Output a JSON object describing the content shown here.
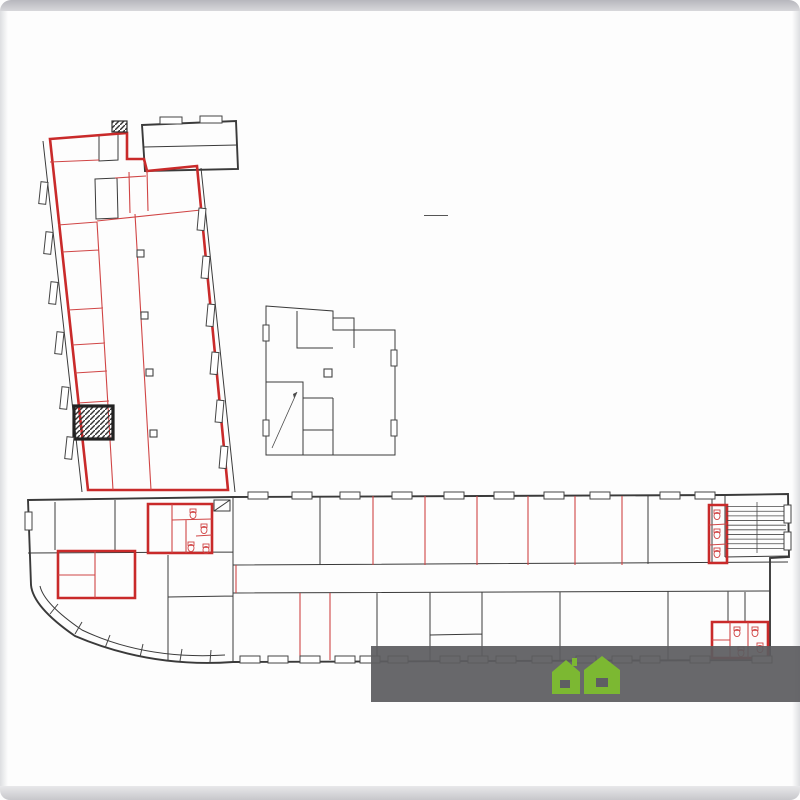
{
  "title": {
    "floor_number": "2",
    "floor_word": "ЭТАЖ"
  },
  "watermark": {
    "text_left": "Квартиры-до",
    "text_right": "ики.рф",
    "house_color": "#7cb832"
  },
  "plan": {
    "accent_red": "#c92a2a",
    "stair_letters": [
      "А",
      "Б",
      "В",
      "Г"
    ],
    "stair_numerals": [
      "I",
      "II",
      "III"
    ],
    "labels": [
      {
        "t": "11а",
        "a": "12.4",
        "x": 73,
        "y": 149,
        "c": "r"
      },
      {
        "t": "12",
        "x": 108,
        "y": 148,
        "c": "k"
      },
      {
        "t": "10",
        "a": "12.6",
        "x": 122,
        "y": 164,
        "c": "r"
      },
      {
        "t": "9",
        "x": 106,
        "y": 199,
        "c": "k"
      },
      {
        "t": "11",
        "a": "11.2",
        "x": 72,
        "y": 191,
        "c": "r"
      },
      {
        "t": "13",
        "a": "5.8",
        "x": 137,
        "y": 184,
        "c": "r"
      },
      {
        "t": "14",
        "a": "10.7",
        "x": 170,
        "y": 180,
        "c": "r"
      },
      {
        "t": "7",
        "a": "11.5",
        "x": 75,
        "y": 232,
        "c": "r"
      },
      {
        "t": "6",
        "a": "15.4",
        "x": 81,
        "y": 280,
        "c": "r"
      },
      {
        "t": "5",
        "a": "9.0",
        "x": 86,
        "y": 325,
        "c": "r"
      },
      {
        "t": "4",
        "a": "8.1",
        "x": 89,
        "y": 355,
        "c": "r"
      },
      {
        "t": "3",
        "a": "8.0",
        "x": 88,
        "y": 387,
        "c": "r"
      },
      {
        "t": "2",
        "a": "6.1",
        "x": 93,
        "y": 419,
        "c": "r"
      },
      {
        "t": "1",
        "a": "16.1",
        "x": 96,
        "y": 459,
        "c": "r"
      },
      {
        "t": "8",
        "a": "34.7",
        "x": 116,
        "y": 334,
        "c": "r"
      },
      {
        "t": "15",
        "a": "177.2",
        "x": 168,
        "y": 345,
        "c": "r"
      },
      {
        "t": "3.20",
        "x": 50,
        "y": 153,
        "c": "dr",
        "v": 1
      },
      {
        "t": "4.59",
        "x": 77,
        "y": 169,
        "c": "dk"
      },
      {
        "t": "1.92",
        "x": 116,
        "y": 137,
        "c": "dk"
      },
      {
        "t": "3.40",
        "x": 80,
        "y": 208,
        "c": "dk"
      },
      {
        "t": "3.40",
        "x": 167,
        "y": 200,
        "c": "dk"
      },
      {
        "t": "3.13",
        "x": 196,
        "y": 186,
        "c": "dk",
        "v": 1
      },
      {
        "t": "7.25",
        "x": 170,
        "y": 219,
        "c": "dr"
      },
      {
        "t": "3.22",
        "x": 77,
        "y": 251,
        "c": "dr"
      },
      {
        "t": "3.58",
        "x": 56,
        "y": 236,
        "c": "dr",
        "v": 1
      },
      {
        "t": "3.30",
        "x": 80,
        "y": 303,
        "c": "dr"
      },
      {
        "t": "4.68",
        "x": 60,
        "y": 283,
        "c": "dr",
        "v": 1
      },
      {
        "t": "3.30",
        "x": 82,
        "y": 342,
        "c": "dr"
      },
      {
        "t": "2.75",
        "x": 63,
        "y": 330,
        "c": "dr",
        "v": 1
      },
      {
        "t": "3.30",
        "x": 77,
        "y": 371,
        "c": "dr"
      },
      {
        "t": "2.46",
        "x": 66,
        "y": 357,
        "c": "dr",
        "v": 1
      },
      {
        "t": "3.25",
        "x": 88,
        "y": 380,
        "c": "dr"
      },
      {
        "t": "2.48",
        "x": 68,
        "y": 389,
        "c": "dr",
        "v": 1
      },
      {
        "t": "3.22",
        "x": 86,
        "y": 445,
        "c": "dr"
      },
      {
        "t": "4.92",
        "x": 67,
        "y": 464,
        "c": "dr",
        "v": 1
      },
      {
        "t": "5.10",
        "x": 113,
        "y": 465,
        "c": "dr",
        "v": 1
      },
      {
        "t": "8.42",
        "x": 117,
        "y": 293,
        "c": "dr",
        "v": 1
      },
      {
        "t": "24.45",
        "x": 132,
        "y": 382,
        "c": "dr",
        "v": 1
      },
      {
        "t": "15.85",
        "x": 126,
        "y": 427,
        "c": "dr",
        "v": 1
      },
      {
        "t": "А",
        "x": 136,
        "y": 141,
        "c": "k",
        "fs": 10
      },
      {
        "t": "3",
        "a": "8.3",
        "x": 315,
        "y": 326,
        "c": "k"
      },
      {
        "t": "2",
        "a": "82.7",
        "x": 366,
        "y": 404,
        "c": "k"
      },
      {
        "t": "1",
        "a": "7.8",
        "x": 318,
        "y": 444,
        "c": "k"
      },
      {
        "t": "Г",
        "x": 292,
        "y": 394,
        "c": "k",
        "fs": 10
      },
      {
        "t": "III",
        "x": 278,
        "y": 393,
        "c": "r",
        "fs": 8,
        "box": 1
      },
      {
        "t": "2.28",
        "x": 284,
        "y": 317,
        "c": "dk"
      },
      {
        "t": "2.82",
        "x": 314,
        "y": 315,
        "c": "dk"
      },
      {
        "t": "2.95",
        "x": 301,
        "y": 331,
        "c": "dk",
        "v": 1
      },
      {
        "t": "2.97",
        "x": 313,
        "y": 353,
        "c": "dk"
      },
      {
        "t": "5.72",
        "x": 272,
        "y": 349,
        "c": "dk",
        "v": 1
      },
      {
        "t": "5.08",
        "x": 310,
        "y": 366,
        "c": "dk"
      },
      {
        "t": "6.05",
        "x": 271,
        "y": 412,
        "c": "dk",
        "v": 1
      },
      {
        "t": "2.52",
        "x": 289,
        "y": 452,
        "c": "dk"
      },
      {
        "t": "2.23",
        "x": 320,
        "y": 397,
        "c": "dk"
      },
      {
        "t": "2.12",
        "x": 309,
        "y": 428,
        "c": "dk",
        "v": 1
      },
      {
        "t": "4.07",
        "x": 302,
        "y": 416,
        "c": "dk",
        "v": 1
      },
      {
        "t": "7.35",
        "x": 338,
        "y": 414,
        "c": "dk",
        "v": 1
      },
      {
        "t": "Б",
        "x": 47,
        "y": 523,
        "c": "k",
        "fs": 10
      },
      {
        "t": "I",
        "x": 133,
        "y": 514,
        "c": "r",
        "fs": 8,
        "box": 1
      },
      {
        "t": "В",
        "x": 753,
        "y": 508,
        "c": "k",
        "fs": 10
      },
      {
        "t": "II",
        "x": 744,
        "y": 554,
        "c": "r",
        "fs": 8,
        "box": 1
      },
      {
        "t": "3.75",
        "x": 36,
        "y": 525,
        "c": "dk",
        "v": 1
      },
      {
        "t": "10.34",
        "x": 131,
        "y": 545,
        "c": "dk"
      },
      {
        "t": "5.67",
        "x": 200,
        "y": 561,
        "c": "dk"
      },
      {
        "t": "5",
        "a": "7.4",
        "x": 159,
        "y": 522,
        "c": "r"
      },
      {
        "t": "8",
        "x": 187,
        "y": 514,
        "c": "r",
        "fs": 6
      },
      {
        "t": "6",
        "x": 186,
        "y": 528,
        "c": "r",
        "fs": 6
      },
      {
        "t": "7",
        "x": 201,
        "y": 547,
        "c": "r",
        "fs": 6
      },
      {
        "t": "9",
        "x": 221,
        "y": 530,
        "c": "k"
      },
      {
        "t": "10",
        "a": "45.9",
        "x": 277,
        "y": 530,
        "c": "k"
      },
      {
        "t": "11",
        "a": "23.2",
        "x": 351,
        "y": 530,
        "c": "r"
      },
      {
        "t": "12",
        "a": "23.1",
        "x": 401,
        "y": 530,
        "c": "r"
      },
      {
        "t": "13",
        "a": "23.0",
        "x": 451,
        "y": 530,
        "c": "r"
      },
      {
        "t": "14",
        "a": "23.0",
        "x": 502,
        "y": 530,
        "c": "r"
      },
      {
        "t": "15",
        "a": "23.0",
        "x": 551,
        "y": 530,
        "c": "r"
      },
      {
        "t": "16",
        "a": "23.1",
        "x": 598,
        "y": 530,
        "c": "r"
      },
      {
        "t": "17",
        "a": "10.7",
        "x": 636,
        "y": 530,
        "c": "r"
      },
      {
        "t": "18",
        "a": "24.3",
        "x": 679,
        "y": 527,
        "c": "k"
      },
      {
        "t": "19",
        "x": 718,
        "y": 517,
        "c": "r",
        "fs": 6
      },
      {
        "t": "37",
        "a": "108.5",
        "x": 497,
        "y": 577,
        "c": "r"
      },
      {
        "t": "8.27",
        "x": 280,
        "y": 506,
        "c": "dk"
      },
      {
        "t": "4.18",
        "x": 352,
        "y": 504,
        "c": "dr"
      },
      {
        "t": "4.20",
        "x": 403,
        "y": 504,
        "c": "dr"
      },
      {
        "t": "4.18",
        "x": 451,
        "y": 506,
        "c": "dr"
      },
      {
        "t": "4.19",
        "x": 503,
        "y": 506,
        "c": "dr"
      },
      {
        "t": "4.19",
        "x": 553,
        "y": 506,
        "c": "dr"
      },
      {
        "t": "4.22",
        "x": 600,
        "y": 504,
        "c": "dr"
      },
      {
        "t": "1.97",
        "x": 638,
        "y": 504,
        "c": "dr"
      },
      {
        "t": "4.45",
        "x": 679,
        "y": 507,
        "c": "dk"
      },
      {
        "t": "5.55",
        "x": 327,
        "y": 532,
        "c": "dk",
        "v": 1
      },
      {
        "t": "5.50",
        "x": 372,
        "y": 541,
        "c": "dk",
        "v": 1
      },
      {
        "t": "5.50",
        "x": 428,
        "y": 542,
        "c": "dr",
        "v": 1
      },
      {
        "t": "5.50",
        "x": 473,
        "y": 537,
        "c": "dr",
        "v": 1
      },
      {
        "t": "5.47",
        "x": 523,
        "y": 537,
        "c": "dr",
        "v": 1
      },
      {
        "t": "5.47",
        "x": 571,
        "y": 538,
        "c": "dr",
        "v": 1
      },
      {
        "t": "5.48",
        "x": 620,
        "y": 537,
        "c": "dr",
        "v": 1
      },
      {
        "t": "5.47",
        "x": 695,
        "y": 547,
        "c": "dk",
        "v": 1
      },
      {
        "t": "2.37",
        "x": 231,
        "y": 580,
        "c": "dr",
        "v": 1
      },
      {
        "t": "46.08",
        "x": 546,
        "y": 592,
        "c": "dk"
      },
      {
        "t": "2",
        "a": "15.8",
        "x": 63,
        "y": 572,
        "c": "r"
      },
      {
        "t": "3",
        "x": 84,
        "y": 564,
        "c": "r",
        "fs": 6
      },
      {
        "t": "3.03",
        "x": 60,
        "y": 556,
        "c": "dr"
      },
      {
        "t": "3.57",
        "x": 52,
        "y": 576,
        "c": "dr",
        "v": 1
      },
      {
        "t": "2.66",
        "x": 83,
        "y": 573,
        "c": "dr"
      },
      {
        "t": "4.04",
        "x": 116,
        "y": 576,
        "c": "dr",
        "v": 1
      },
      {
        "t": "5.91",
        "x": 96,
        "y": 602,
        "c": "dr"
      },
      {
        "t": "9.37",
        "x": 150,
        "y": 602,
        "c": "dk",
        "v": 1
      },
      {
        "t": "1",
        "a": "72.8",
        "x": 127,
        "y": 609,
        "c": "r"
      },
      {
        "t": "4",
        "a": "29.5",
        "x": 193,
        "y": 575,
        "c": "k"
      },
      {
        "t": "5.25",
        "x": 166,
        "y": 577,
        "c": "dk",
        "v": 1
      },
      {
        "t": "36",
        "a": "22.8",
        "x": 190,
        "y": 637,
        "c": "k"
      },
      {
        "t": "5.65",
        "x": 198,
        "y": 622,
        "c": "dk"
      },
      {
        "t": "4.04",
        "x": 166,
        "y": 640,
        "c": "dk",
        "v": 1
      },
      {
        "t": "35",
        "a": "34.1",
        "x": 266,
        "y": 627,
        "c": "r"
      },
      {
        "t": "6.15",
        "x": 267,
        "y": 657,
        "c": "dr"
      },
      {
        "t": "5.50",
        "x": 240,
        "y": 631,
        "c": "dk",
        "v": 1
      },
      {
        "t": "34",
        "a": "11.4",
        "x": 314,
        "y": 626,
        "c": "r"
      },
      {
        "t": "2.07",
        "x": 313,
        "y": 657,
        "c": "dr"
      },
      {
        "t": "33",
        "a": "23.1",
        "x": 353,
        "y": 626,
        "c": "k"
      },
      {
        "t": "4.18",
        "x": 355,
        "y": 658,
        "c": "dk"
      },
      {
        "t": "32",
        "a": "23.1",
        "x": 394,
        "y": 627,
        "c": "k"
      },
      {
        "t": "30",
        "a": "11.4",
        "x": 458,
        "y": 611,
        "c": "k"
      },
      {
        "t": "2.73",
        "x": 441,
        "y": 616,
        "c": "dk",
        "v": 1
      },
      {
        "t": "4.17",
        "x": 452,
        "y": 628,
        "c": "dk"
      },
      {
        "t": "31",
        "a": "11.1",
        "x": 456,
        "y": 646,
        "c": "k"
      },
      {
        "t": "29",
        "a": "34.8",
        "x": 518,
        "y": 627,
        "c": "k"
      },
      {
        "t": "5.45",
        "x": 490,
        "y": 629,
        "c": "dk",
        "v": 1
      },
      {
        "t": "28",
        "a": "58.4",
        "x": 623,
        "y": 625,
        "c": "k"
      },
      {
        "t": "27",
        "a": "21.7",
        "x": 709,
        "y": 627,
        "c": "k"
      },
      {
        "t": "3.85",
        "x": 701,
        "y": 603,
        "c": "dk"
      },
      {
        "t": "20",
        "x": 757,
        "y": 610,
        "c": "k"
      },
      {
        "t": "23",
        "x": 736,
        "y": 612,
        "c": "r",
        "fs": 6
      }
    ]
  }
}
